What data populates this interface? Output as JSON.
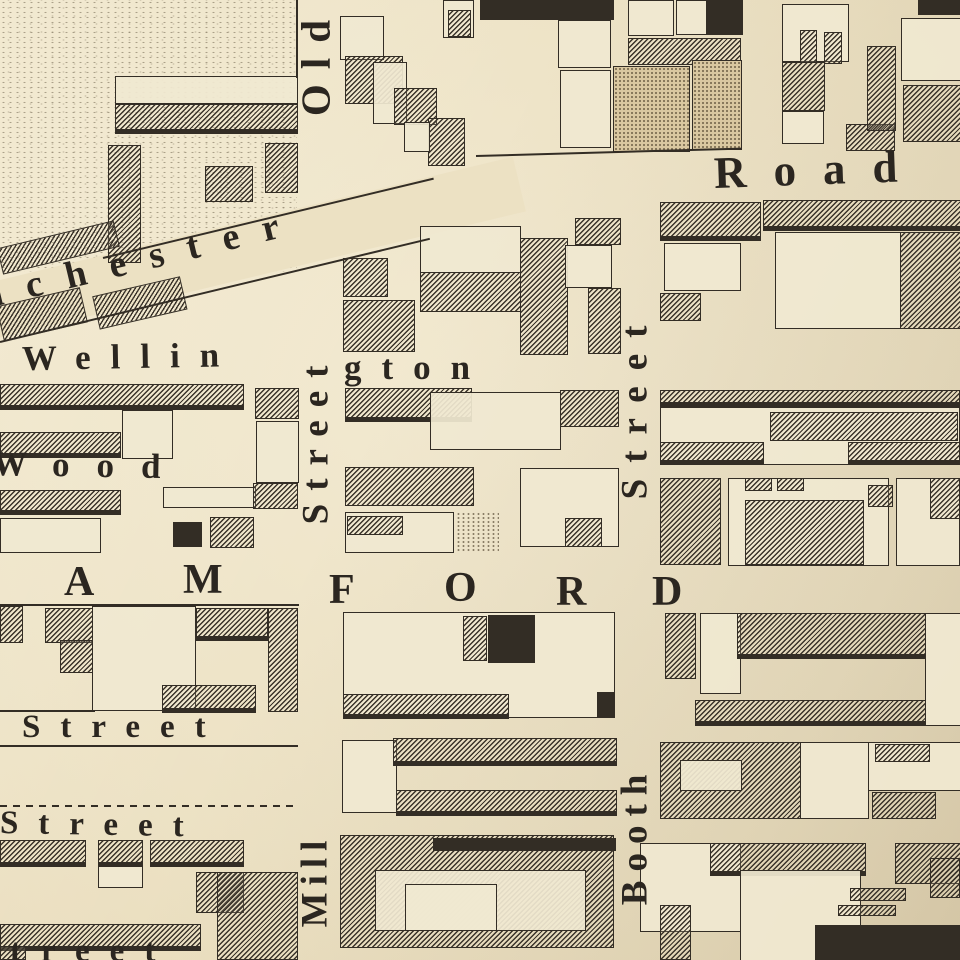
{
  "map": {
    "palette": {
      "paper": "#ece1c3",
      "ink": "#332d25",
      "stipple_block": "#d9c7a0"
    },
    "streets": {
      "diagonal_road": "nchester ... Road (Manchester Road)",
      "vertical_left": "Old Street / Mill",
      "vertical_right": "Booth Street",
      "horizontal": [
        "Wellington",
        "Wood",
        "Stamford (A M F O R D)",
        "Street",
        "Street",
        "treet"
      ]
    },
    "labels": [
      {
        "id": "road",
        "t": "Road",
        "x": 714,
        "y": 150,
        "fs": 45,
        "ls": 27,
        "r": -2
      },
      {
        "id": "manchester",
        "t": "nchester",
        "x": -18,
        "y": 278,
        "fs": 38,
        "ls": 24,
        "r": -13.5
      },
      {
        "id": "wellington-1",
        "t": "Wellin",
        "x": 22,
        "y": 341,
        "fs": 35,
        "ls": 20,
        "r": -1
      },
      {
        "id": "wellington-2",
        "t": "gton",
        "x": 344,
        "y": 350,
        "fs": 35,
        "ls": 20,
        "r": 0
      },
      {
        "id": "wood",
        "t": "Wood",
        "x": -8,
        "y": 446,
        "fs": 35,
        "ls": 27,
        "r": 1
      },
      {
        "id": "stamford-A",
        "t": "A",
        "x": 64,
        "y": 560,
        "fs": 42,
        "ls": 0,
        "r": 0
      },
      {
        "id": "stamford-M",
        "t": "M",
        "x": 183,
        "y": 558,
        "fs": 42,
        "ls": 0,
        "r": 0
      },
      {
        "id": "stamford-F",
        "t": "F",
        "x": 329,
        "y": 568,
        "fs": 42,
        "ls": 0,
        "r": 0
      },
      {
        "id": "stamford-O",
        "t": "O",
        "x": 444,
        "y": 566,
        "fs": 42,
        "ls": 0,
        "r": 0
      },
      {
        "id": "stamford-R",
        "t": "R",
        "x": 556,
        "y": 570,
        "fs": 42,
        "ls": 0,
        "r": 0
      },
      {
        "id": "stamford-D",
        "t": "D",
        "x": 652,
        "y": 570,
        "fs": 42,
        "ls": 0,
        "r": 0
      },
      {
        "id": "street-h1",
        "t": "Street",
        "x": 22,
        "y": 710,
        "fs": 33,
        "ls": 20,
        "r": 0
      },
      {
        "id": "street-h2",
        "t": "Street",
        "x": 0,
        "y": 806,
        "fs": 33,
        "ls": 20,
        "r": 1
      },
      {
        "id": "street-h3",
        "t": "treet",
        "x": 10,
        "y": 934,
        "fs": 33,
        "ls": 20,
        "r": 0
      },
      {
        "id": "old",
        "t": "Old",
        "v": 1,
        "cx": 316,
        "cy": 69,
        "L": 140,
        "fs": 41,
        "ls": 15
      },
      {
        "id": "street-v-old",
        "t": "Street",
        "v": 1,
        "cx": 317,
        "cy": 446,
        "L": 232,
        "fs": 37,
        "ls": 13
      },
      {
        "id": "street-v-booth",
        "t": "Street",
        "v": 1,
        "cx": 636,
        "cy": 412,
        "L": 256,
        "fs": 37,
        "ls": 16
      },
      {
        "id": "booth",
        "t": "Booth",
        "v": 1,
        "cx": 636,
        "cy": 843,
        "L": 192,
        "fs": 37,
        "ls": 9
      },
      {
        "id": "mill",
        "t": "Mill",
        "v": 1,
        "cx": 316,
        "cy": 888,
        "L": 146,
        "fs": 37,
        "ls": 7
      }
    ],
    "band": {
      "x": -30,
      "y": 288,
      "w": 565,
      "h": 56,
      "r": -13.5
    },
    "lines": [
      {
        "x": 0,
        "y": 745,
        "w": 298,
        "h": 2,
        "dash": 0,
        "r": 0
      },
      {
        "x": 0,
        "y": 805,
        "w": 296,
        "h": 2,
        "dash": 1,
        "r": 0
      },
      {
        "x": 476,
        "y": 155,
        "w": 266,
        "h": 2,
        "dash": 0,
        "r": -1.6
      },
      {
        "x": 103,
        "y": 257,
        "w": 340,
        "h": 2,
        "dash": 0,
        "r": -13.5
      },
      {
        "x": 0,
        "y": 341,
        "w": 442,
        "h": 2,
        "dash": 0,
        "r": -13.5
      },
      {
        "x": 296,
        "y": 0,
        "w": 2,
        "h": 78,
        "dash": 0,
        "r": 0
      },
      {
        "x": 0,
        "y": 604,
        "w": 299,
        "h": 2,
        "dash": 0,
        "r": 0
      },
      {
        "x": 0,
        "y": 710,
        "w": 95,
        "h": 2,
        "dash": 0,
        "r": 0
      }
    ],
    "blocks": [
      [
        0,
        0,
        297,
        272,
        "f",
        0,
        0
      ],
      [
        115,
        76,
        183,
        28,
        "o",
        0,
        0
      ],
      [
        115,
        104,
        183,
        30,
        "h",
        0,
        1
      ],
      [
        108,
        145,
        33,
        118,
        "h",
        0,
        0
      ],
      [
        265,
        143,
        33,
        50,
        "h",
        0,
        0
      ],
      [
        205,
        166,
        48,
        36,
        "h",
        0,
        0
      ],
      [
        0,
        248,
        120,
        27,
        "h",
        -13.5,
        0
      ],
      [
        0,
        306,
        86,
        36,
        "h",
        -13,
        0
      ],
      [
        96,
        296,
        90,
        34,
        "h",
        -13,
        0
      ],
      [
        340,
        16,
        44,
        44,
        "o",
        0,
        0
      ],
      [
        443,
        0,
        31,
        38,
        "o",
        0,
        0
      ],
      [
        448,
        10,
        23,
        27,
        "h",
        0,
        0
      ],
      [
        345,
        56,
        58,
        48,
        "h",
        0,
        0
      ],
      [
        373,
        62,
        34,
        62,
        "o",
        0,
        0
      ],
      [
        394,
        88,
        43,
        37,
        "h",
        0,
        0
      ],
      [
        428,
        118,
        37,
        48,
        "h",
        0,
        0
      ],
      [
        404,
        122,
        26,
        30,
        "o",
        0,
        0
      ],
      [
        480,
        0,
        134,
        20,
        "s",
        0,
        0
      ],
      [
        558,
        20,
        53,
        48,
        "o",
        0,
        0
      ],
      [
        560,
        70,
        51,
        78,
        "o",
        0,
        0
      ],
      [
        628,
        0,
        46,
        36,
        "o",
        0,
        0
      ],
      [
        628,
        38,
        113,
        27,
        "h",
        0,
        0
      ],
      [
        613,
        66,
        77,
        86,
        "p",
        0,
        0
      ],
      [
        692,
        60,
        50,
        90,
        "p",
        0,
        0
      ],
      [
        676,
        0,
        31,
        35,
        "o",
        0,
        0
      ],
      [
        707,
        0,
        36,
        35,
        "s",
        0,
        0
      ],
      [
        782,
        4,
        67,
        58,
        "o",
        0,
        0
      ],
      [
        800,
        30,
        17,
        33,
        "h",
        0,
        0
      ],
      [
        824,
        32,
        18,
        32,
        "h",
        0,
        0
      ],
      [
        782,
        62,
        43,
        49,
        "h",
        0,
        0
      ],
      [
        782,
        111,
        42,
        33,
        "o",
        0,
        0
      ],
      [
        846,
        124,
        49,
        27,
        "h",
        0,
        0
      ],
      [
        867,
        46,
        29,
        85,
        "h",
        0,
        0
      ],
      [
        901,
        18,
        60,
        63,
        "o",
        0,
        0
      ],
      [
        903,
        85,
        58,
        57,
        "h",
        0,
        0
      ],
      [
        918,
        0,
        42,
        15,
        "s",
        0,
        0
      ],
      [
        660,
        202,
        101,
        39,
        "h",
        0,
        1
      ],
      [
        664,
        243,
        77,
        48,
        "o",
        0,
        0
      ],
      [
        660,
        293,
        41,
        28,
        "h",
        0,
        0
      ],
      [
        763,
        200,
        198,
        31,
        "h",
        0,
        1
      ],
      [
        775,
        232,
        126,
        97,
        "o",
        0,
        0
      ],
      [
        900,
        232,
        61,
        97,
        "h",
        0,
        0
      ],
      [
        343,
        258,
        45,
        39,
        "h",
        0,
        0
      ],
      [
        343,
        300,
        72,
        52,
        "h",
        0,
        0
      ],
      [
        420,
        226,
        101,
        47,
        "o",
        0,
        0
      ],
      [
        420,
        272,
        101,
        40,
        "h",
        0,
        0
      ],
      [
        520,
        238,
        48,
        117,
        "h",
        0,
        0
      ],
      [
        565,
        245,
        47,
        43,
        "o",
        0,
        0
      ],
      [
        575,
        218,
        46,
        27,
        "h",
        0,
        0
      ],
      [
        588,
        288,
        33,
        66,
        "h",
        0,
        0
      ],
      [
        0,
        384,
        244,
        26,
        "h",
        0,
        1
      ],
      [
        122,
        410,
        51,
        49,
        "o",
        0,
        0
      ],
      [
        0,
        432,
        121,
        26,
        "h",
        0,
        1
      ],
      [
        255,
        388,
        44,
        31,
        "h",
        0,
        0
      ],
      [
        256,
        421,
        43,
        62,
        "o",
        0,
        0
      ],
      [
        0,
        490,
        121,
        25,
        "h",
        0,
        1
      ],
      [
        163,
        487,
        93,
        21,
        "o",
        0,
        0
      ],
      [
        173,
        522,
        29,
        25,
        "s",
        0,
        0
      ],
      [
        253,
        483,
        45,
        26,
        "h",
        0,
        0
      ],
      [
        0,
        518,
        101,
        35,
        "o",
        0,
        0
      ],
      [
        210,
        517,
        44,
        31,
        "h",
        0,
        0
      ],
      [
        345,
        388,
        127,
        34,
        "h",
        0,
        1
      ],
      [
        430,
        392,
        131,
        58,
        "o",
        0,
        0
      ],
      [
        560,
        390,
        59,
        37,
        "h",
        0,
        0
      ],
      [
        345,
        467,
        129,
        39,
        "h",
        0,
        0
      ],
      [
        520,
        468,
        99,
        79,
        "o",
        0,
        0
      ],
      [
        345,
        512,
        109,
        41,
        "o",
        0,
        0
      ],
      [
        347,
        516,
        56,
        19,
        "h",
        0,
        0
      ],
      [
        456,
        512,
        43,
        41,
        "d",
        0,
        0
      ],
      [
        565,
        518,
        37,
        29,
        "h",
        0,
        0
      ],
      [
        0,
        606,
        23,
        37,
        "h",
        0,
        0
      ],
      [
        45,
        608,
        48,
        35,
        "h",
        0,
        0
      ],
      [
        60,
        640,
        33,
        33,
        "h",
        0,
        0
      ],
      [
        92,
        606,
        104,
        105,
        "o",
        0,
        0
      ],
      [
        196,
        608,
        72,
        33,
        "h",
        0,
        1
      ],
      [
        268,
        608,
        30,
        104,
        "h",
        0,
        0
      ],
      [
        162,
        685,
        94,
        28,
        "h",
        0,
        1
      ],
      [
        0,
        840,
        86,
        27,
        "h",
        0,
        1
      ],
      [
        98,
        840,
        45,
        27,
        "h",
        0,
        1
      ],
      [
        150,
        840,
        94,
        27,
        "h",
        0,
        1
      ],
      [
        98,
        866,
        45,
        22,
        "o",
        0,
        0
      ],
      [
        196,
        872,
        48,
        41,
        "h",
        0,
        0
      ],
      [
        217,
        872,
        81,
        88,
        "h",
        0,
        0
      ],
      [
        0,
        924,
        201,
        27,
        "h",
        0,
        1
      ],
      [
        0,
        946,
        26,
        14,
        "h",
        0,
        0
      ],
      [
        343,
        612,
        272,
        106,
        "o",
        0,
        0
      ],
      [
        463,
        616,
        24,
        45,
        "h",
        0,
        0
      ],
      [
        488,
        615,
        47,
        48,
        "s",
        0,
        0
      ],
      [
        343,
        694,
        166,
        25,
        "h",
        0,
        1
      ],
      [
        597,
        692,
        17,
        25,
        "s",
        0,
        0
      ],
      [
        342,
        740,
        55,
        73,
        "o",
        0,
        0
      ],
      [
        393,
        738,
        224,
        28,
        "h",
        0,
        1
      ],
      [
        396,
        790,
        221,
        26,
        "h",
        0,
        1
      ],
      [
        340,
        835,
        274,
        113,
        "h",
        0,
        0
      ],
      [
        375,
        870,
        211,
        61,
        "o",
        0,
        0
      ],
      [
        433,
        838,
        183,
        13,
        "s",
        0,
        0
      ],
      [
        405,
        884,
        92,
        47,
        "o",
        0,
        0
      ],
      [
        660,
        390,
        300,
        17,
        "h",
        0,
        1
      ],
      [
        660,
        407,
        300,
        58,
        "o",
        0,
        0
      ],
      [
        770,
        412,
        188,
        29,
        "h",
        0,
        0
      ],
      [
        660,
        442,
        104,
        23,
        "h",
        0,
        1
      ],
      [
        848,
        442,
        112,
        23,
        "h",
        0,
        1
      ],
      [
        660,
        478,
        61,
        87,
        "h",
        0,
        0
      ],
      [
        728,
        478,
        161,
        88,
        "o",
        0,
        0
      ],
      [
        745,
        478,
        27,
        13,
        "h",
        0,
        0
      ],
      [
        777,
        478,
        27,
        13,
        "h",
        0,
        0
      ],
      [
        745,
        500,
        119,
        65,
        "h",
        0,
        0
      ],
      [
        868,
        485,
        25,
        22,
        "h",
        0,
        0
      ],
      [
        896,
        478,
        64,
        88,
        "o",
        0,
        0
      ],
      [
        930,
        478,
        30,
        41,
        "h",
        0,
        0
      ],
      [
        665,
        613,
        31,
        66,
        "h",
        0,
        0
      ],
      [
        700,
        613,
        41,
        81,
        "o",
        0,
        0
      ],
      [
        737,
        613,
        189,
        46,
        "h",
        0,
        1
      ],
      [
        925,
        613,
        36,
        113,
        "o",
        0,
        0
      ],
      [
        695,
        700,
        231,
        26,
        "h",
        0,
        1
      ],
      [
        660,
        742,
        141,
        77,
        "h",
        0,
        0
      ],
      [
        680,
        760,
        62,
        31,
        "o",
        0,
        0
      ],
      [
        800,
        742,
        69,
        77,
        "o",
        0,
        0
      ],
      [
        868,
        742,
        93,
        49,
        "o",
        0,
        0
      ],
      [
        875,
        744,
        55,
        18,
        "h",
        0,
        0
      ],
      [
        872,
        792,
        64,
        27,
        "h",
        0,
        0
      ],
      [
        640,
        843,
        101,
        89,
        "o",
        0,
        0
      ],
      [
        710,
        843,
        156,
        33,
        "h",
        0,
        1
      ],
      [
        660,
        905,
        31,
        55,
        "h",
        0,
        0
      ],
      [
        740,
        870,
        121,
        91,
        "o",
        0,
        0
      ],
      [
        850,
        888,
        56,
        13,
        "h",
        0,
        0
      ],
      [
        838,
        905,
        58,
        11,
        "h",
        0,
        0
      ],
      [
        895,
        843,
        66,
        41,
        "h",
        0,
        0
      ],
      [
        930,
        858,
        30,
        40,
        "h",
        0,
        0
      ],
      [
        815,
        925,
        146,
        35,
        "s",
        0,
        0
      ]
    ]
  }
}
